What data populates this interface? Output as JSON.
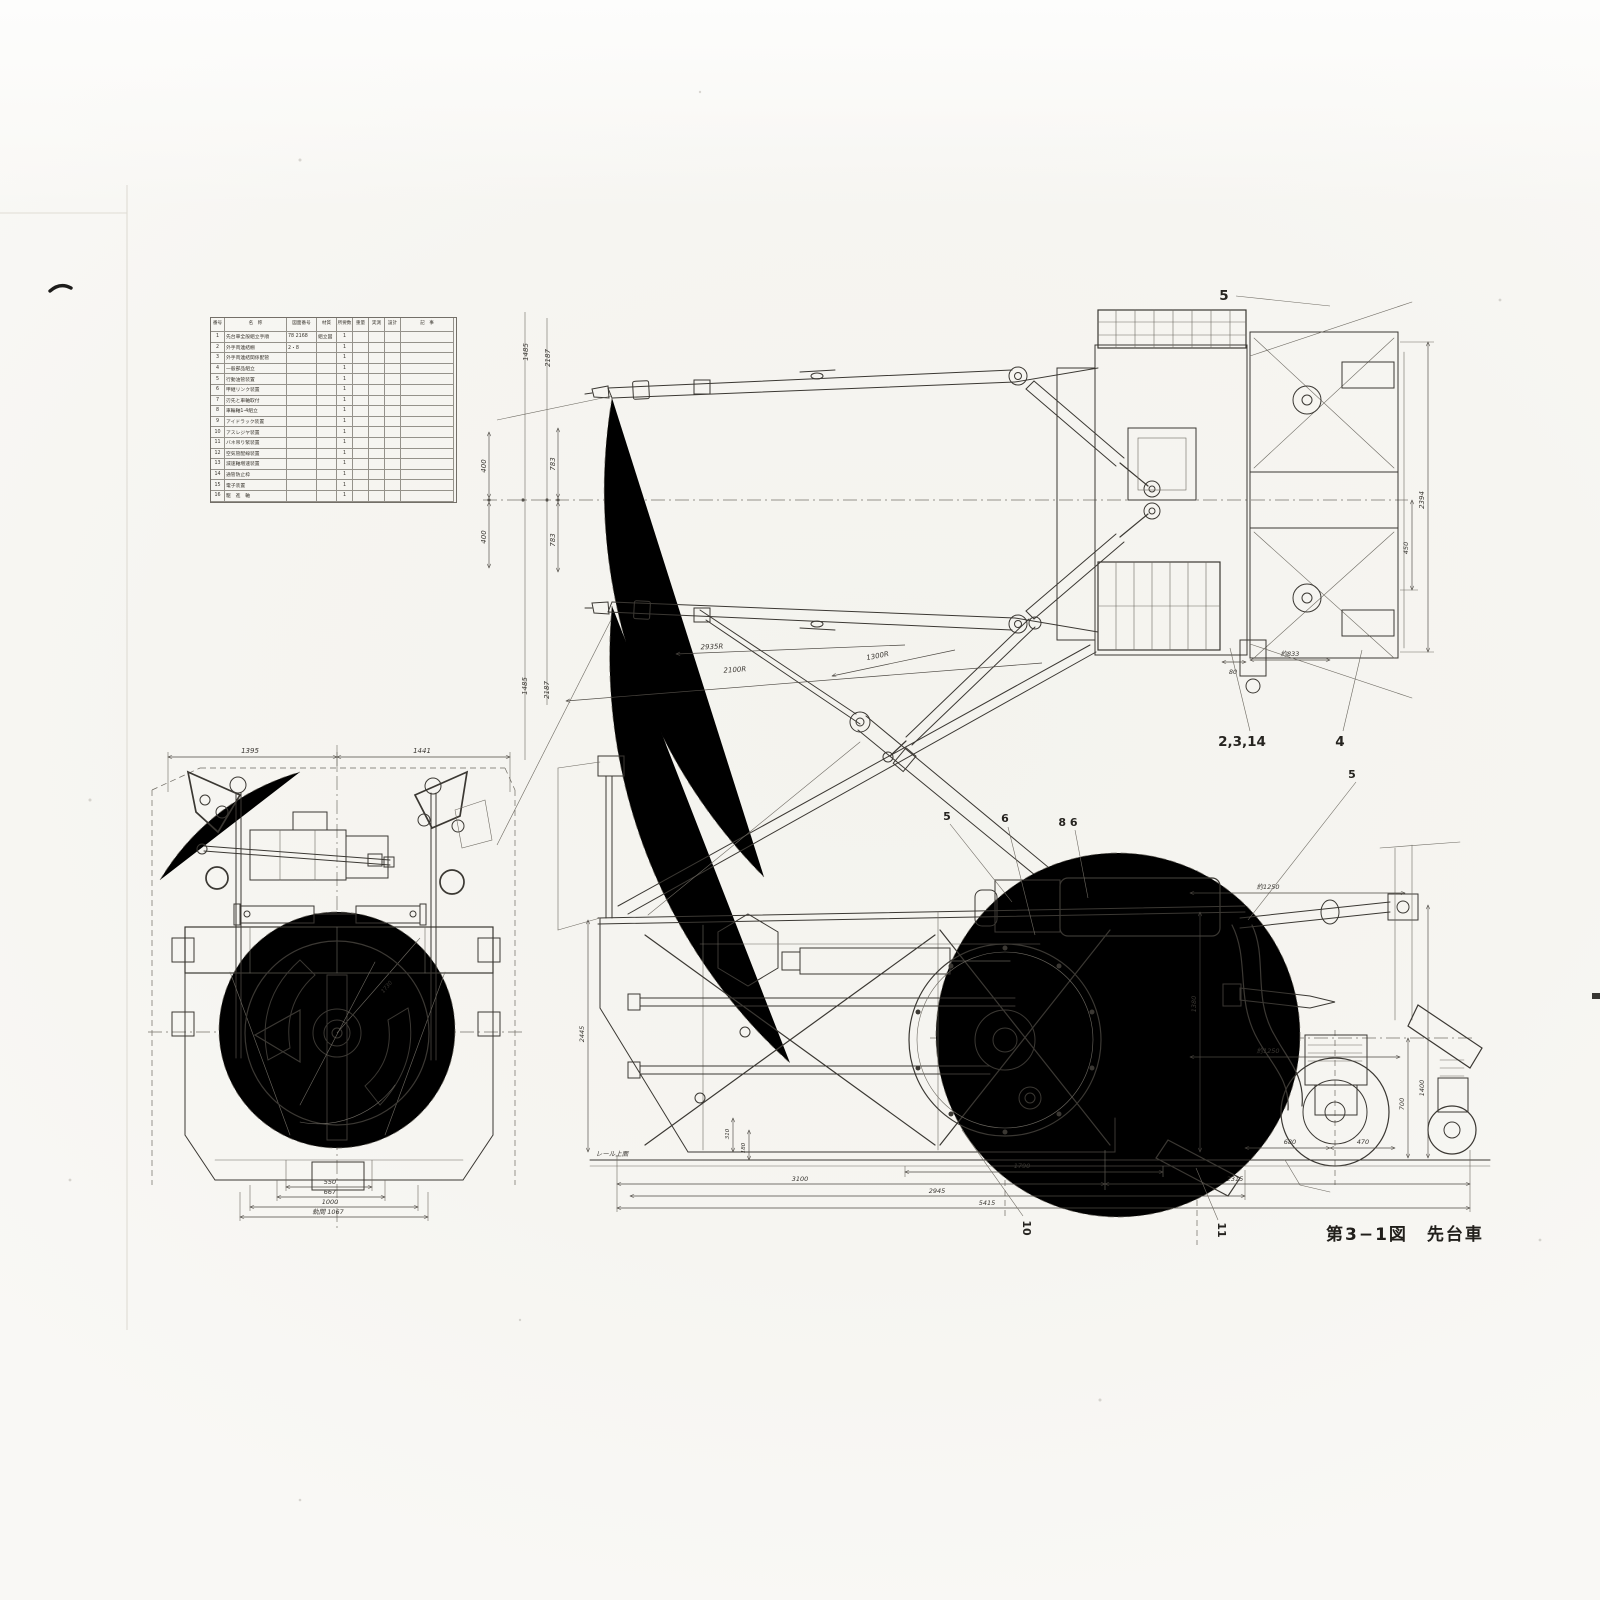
{
  "page": {
    "caption": "第3−1図　先台車"
  },
  "parts_table": {
    "headers": [
      "番号",
      "名　称",
      "図面番号",
      "材質",
      "所要数",
      "重量",
      "実測",
      "設計",
      "記　事"
    ],
    "rows": [
      {
        "no": "1",
        "name": "先台車全般組立手順",
        "dwg": "78 2168",
        "mat": "組立図",
        "qty": "1",
        "w1": "",
        "w2": "",
        "w3": "",
        "rem": ""
      },
      {
        "no": "2",
        "name": "外手両連結棚",
        "dwg": "2・8",
        "mat": "",
        "qty": "1",
        "w1": "",
        "w2": "",
        "w3": "",
        "rem": ""
      },
      {
        "no": "3",
        "name": "外手両連結関係配管",
        "dwg": "",
        "mat": "",
        "qty": "1",
        "w1": "",
        "w2": "",
        "w3": "",
        "rem": ""
      },
      {
        "no": "4",
        "name": "一般部品組立",
        "dwg": "",
        "mat": "",
        "qty": "1",
        "w1": "",
        "w2": "",
        "w3": "",
        "rem": ""
      },
      {
        "no": "5",
        "name": "行動油管装置",
        "dwg": "",
        "mat": "",
        "qty": "1",
        "w1": "",
        "w2": "",
        "w3": "",
        "rem": ""
      },
      {
        "no": "6",
        "name": "甲継リンク装置",
        "dwg": "",
        "mat": "",
        "qty": "1",
        "w1": "",
        "w2": "",
        "w3": "",
        "rem": ""
      },
      {
        "no": "7",
        "name": "刃先と車軸取付",
        "dwg": "",
        "mat": "",
        "qty": "1",
        "w1": "",
        "w2": "",
        "w3": "",
        "rem": ""
      },
      {
        "no": "8",
        "name": "車輪軸1-4組立",
        "dwg": "",
        "mat": "",
        "qty": "1",
        "w1": "",
        "w2": "",
        "w3": "",
        "rem": ""
      },
      {
        "no": "9",
        "name": "アイドラック装置",
        "dwg": "",
        "mat": "",
        "qty": "1",
        "w1": "",
        "w2": "",
        "w3": "",
        "rem": ""
      },
      {
        "no": "10",
        "name": "アスレジヤ装置",
        "dwg": "",
        "mat": "",
        "qty": "1",
        "w1": "",
        "w2": "",
        "w3": "",
        "rem": ""
      },
      {
        "no": "11",
        "name": "バネ吊り緊装置",
        "dwg": "",
        "mat": "",
        "qty": "1",
        "w1": "",
        "w2": "",
        "w3": "",
        "rem": ""
      },
      {
        "no": "12",
        "name": "空気管配線装置",
        "dwg": "",
        "mat": "",
        "qty": "1",
        "w1": "",
        "w2": "",
        "w3": "",
        "rem": ""
      },
      {
        "no": "13",
        "name": "減速軸増速装置",
        "dwg": "",
        "mat": "",
        "qty": "1",
        "w1": "",
        "w2": "",
        "w3": "",
        "rem": ""
      },
      {
        "no": "14",
        "name": "通管防止枠",
        "dwg": "",
        "mat": "",
        "qty": "1",
        "w1": "",
        "w2": "",
        "w3": "",
        "rem": ""
      },
      {
        "no": "15",
        "name": "電子装置",
        "dwg": "",
        "mat": "",
        "qty": "1",
        "w1": "",
        "w2": "",
        "w3": "",
        "rem": ""
      },
      {
        "no": "16",
        "name": "駆　進　軸",
        "dwg": "",
        "mat": "",
        "qty": "1",
        "w1": "",
        "w2": "",
        "w3": "",
        "rem": ""
      }
    ]
  },
  "plan_view": {
    "dims": {
      "w1485u": "1485",
      "w2187u": "2187",
      "o400u": "400",
      "o400l": "400",
      "o783u": "783",
      "o783l": "783",
      "w1485l": "1485",
      "w2187l": "2187",
      "r_outer": "2935R",
      "r_mid": "2100R",
      "r_inner": "1300R",
      "h2394": "2394",
      "h450": "450",
      "d80": "80",
      "d833": "約833"
    },
    "callouts": {
      "c5": "5",
      "c2314": "2,3,14",
      "c4": "4"
    }
  },
  "front_view": {
    "dims": {
      "top_left": "1395",
      "top_right": "1441",
      "b550": "550",
      "b667": "667",
      "b1000": "1000",
      "gauge": "軌間 1067",
      "r1730": "1730"
    }
  },
  "side_view": {
    "dims": {
      "d1790": "1790",
      "d3100": "3100",
      "d2315": "2315",
      "d2945": "2945",
      "d5415": "5415",
      "a1250u": "約1250",
      "a1250l": "約1250",
      "d680": "680",
      "d470": "470",
      "d700": "700",
      "d1400": "1400",
      "d1380": "1380",
      "d2445": "2445",
      "d310": "310",
      "d180": "180"
    },
    "labels": {
      "rail": "レール上面"
    },
    "callouts": {
      "c5a": "5",
      "c6": "6",
      "c86": "8 6",
      "c5b": "5",
      "c10": "10",
      "c11": "11"
    }
  }
}
